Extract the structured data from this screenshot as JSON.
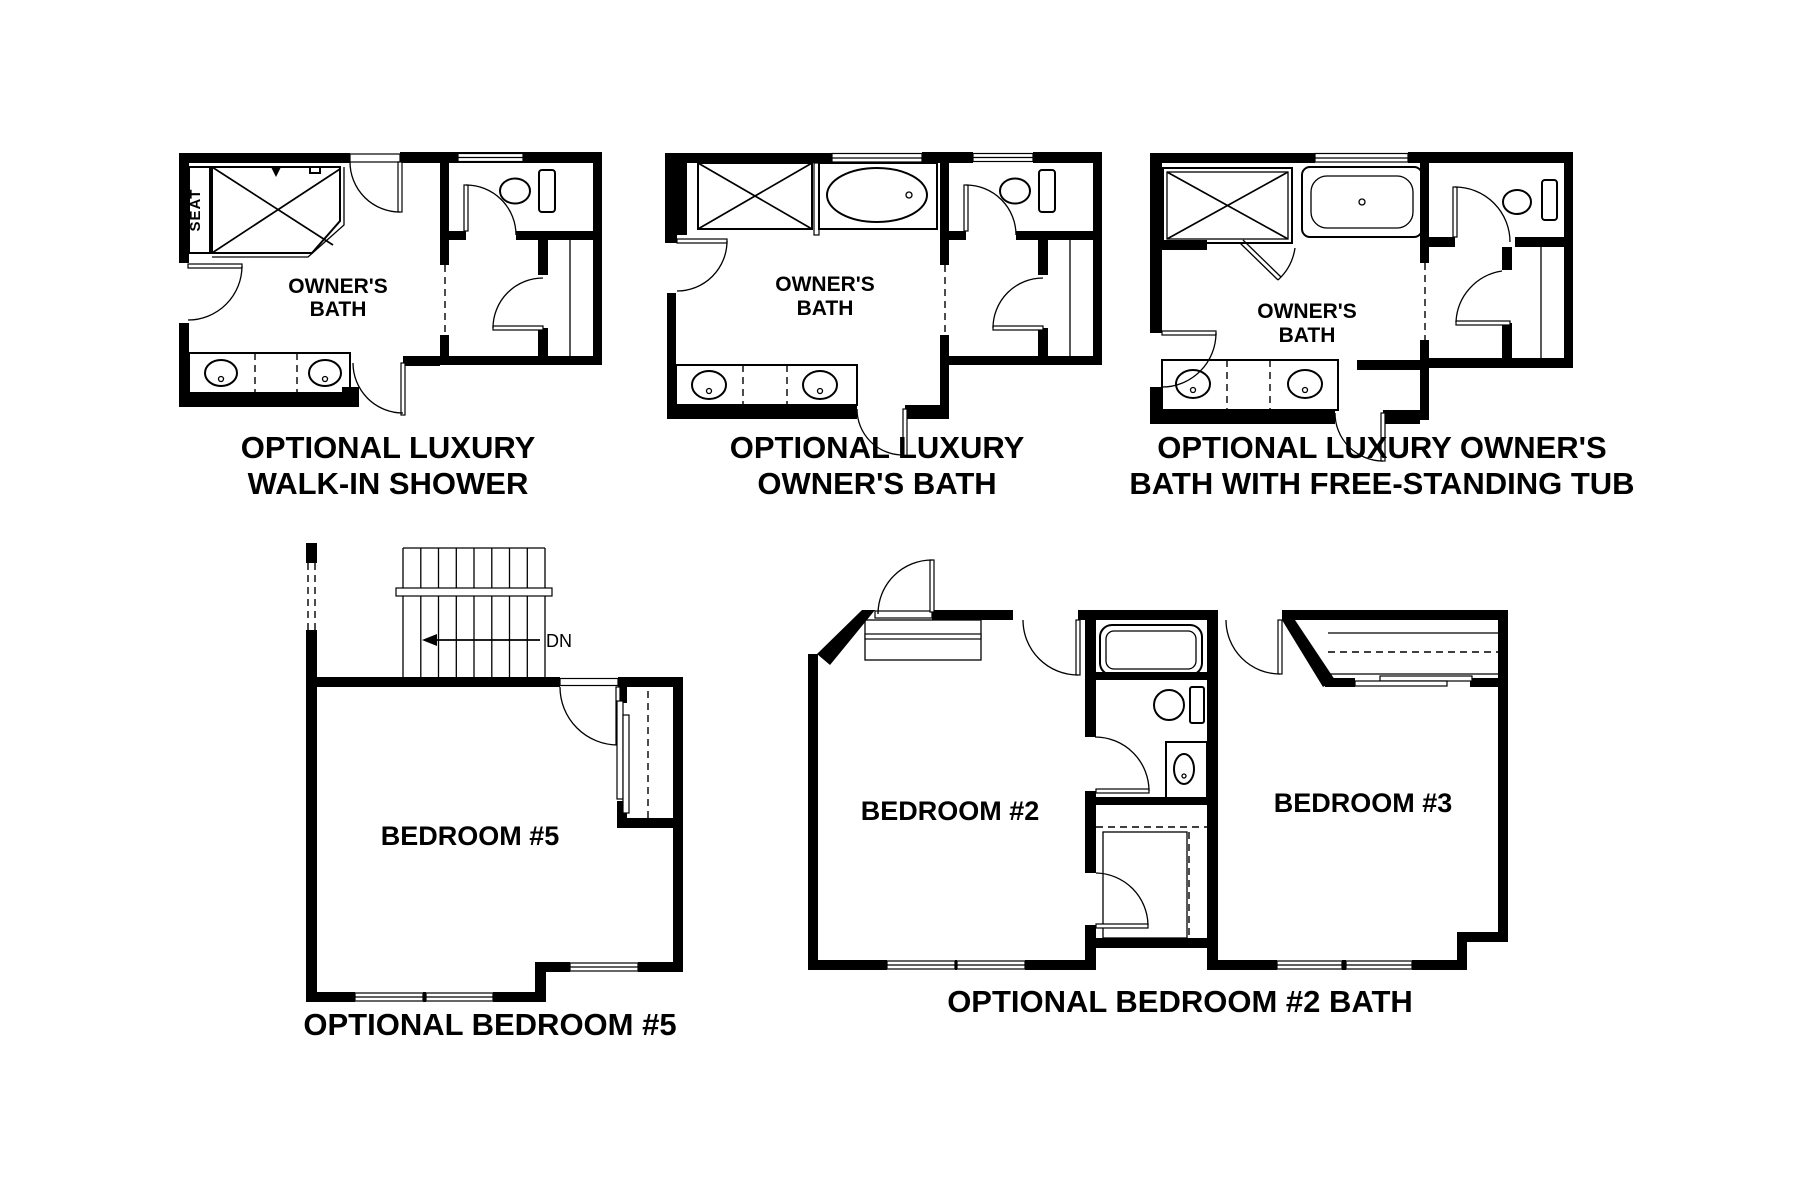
{
  "document": {
    "type": "floor-plan-options-sheet",
    "background_color": "#ffffff",
    "line_color": "#000000"
  },
  "plans": [
    {
      "id": "optional-luxury-walk-in-shower",
      "caption_lines": [
        "OPTIONAL LUXURY",
        "WALK-IN SHOWER"
      ],
      "labels": {
        "room_line1": "OWNER'S",
        "room_line2": "BATH",
        "seat": "SEAT"
      }
    },
    {
      "id": "optional-luxury-owners-bath",
      "caption_lines": [
        "OPTIONAL LUXURY",
        "OWNER'S BATH"
      ],
      "labels": {
        "room_line1": "OWNER'S",
        "room_line2": "BATH"
      }
    },
    {
      "id": "optional-luxury-owners-bath-free-standing-tub",
      "caption_lines": [
        "OPTIONAL LUXURY OWNER'S",
        "BATH WITH FREE-STANDING TUB"
      ],
      "labels": {
        "room_line1": "OWNER'S",
        "room_line2": "BATH"
      }
    },
    {
      "id": "optional-bedroom-5",
      "caption_lines": [
        "OPTIONAL BEDROOM #5"
      ],
      "labels": {
        "room": "BEDROOM #5",
        "stair_direction": "DN"
      }
    },
    {
      "id": "optional-bedroom-2-bath",
      "caption_lines": [
        "OPTIONAL BEDROOM #2 BATH"
      ],
      "labels": {
        "room_left": "BEDROOM #2",
        "room_right": "BEDROOM #3"
      }
    }
  ]
}
